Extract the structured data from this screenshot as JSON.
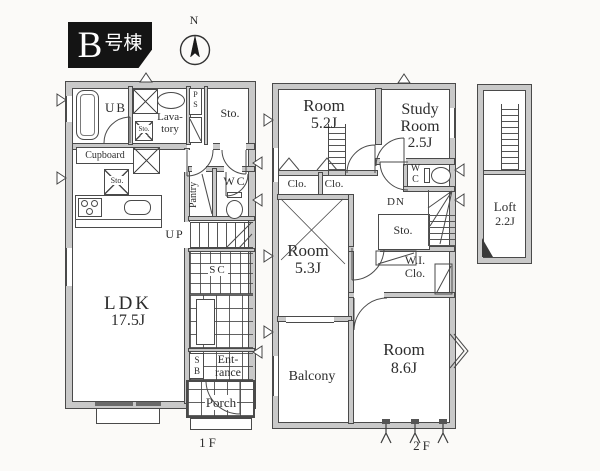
{
  "badge": {
    "initial": "B",
    "suffix": "号棟"
  },
  "compass": {
    "north": "N"
  },
  "f1": {
    "caption": "1F",
    "ub": "UB",
    "lavatory": "Lava-\ntory",
    "ps": "P\nS",
    "sto_top": "Sto.",
    "cupboard": "Cupboard",
    "sto_mid": "Sto.",
    "sto_small": "Sto.",
    "pantry": "Pantry",
    "wc": "WC",
    "up": "UP",
    "sc": "SC",
    "ldk": "LDK",
    "ldk_size": "17.5J",
    "sb": "S\nB",
    "entrance": "Ent-\nrance",
    "porch": "Porch"
  },
  "f2": {
    "caption": "2F",
    "room_a": "Room",
    "room_a_size": "5.2J",
    "study_1": "Study",
    "study_2": "Room",
    "study_size": "2.5J",
    "wc": "W\nC",
    "dn": "DN",
    "sto": "Sto.",
    "clo_l": "Clo.",
    "clo_r": "Clo.",
    "room_b": "Room",
    "room_b_size": "5.3J",
    "wic": "W.I.\nClo.",
    "room_c": "Room",
    "room_c_size": "8.6J",
    "balcony": "Balcony"
  },
  "loft": {
    "name": "Loft",
    "size": "2.2J"
  }
}
